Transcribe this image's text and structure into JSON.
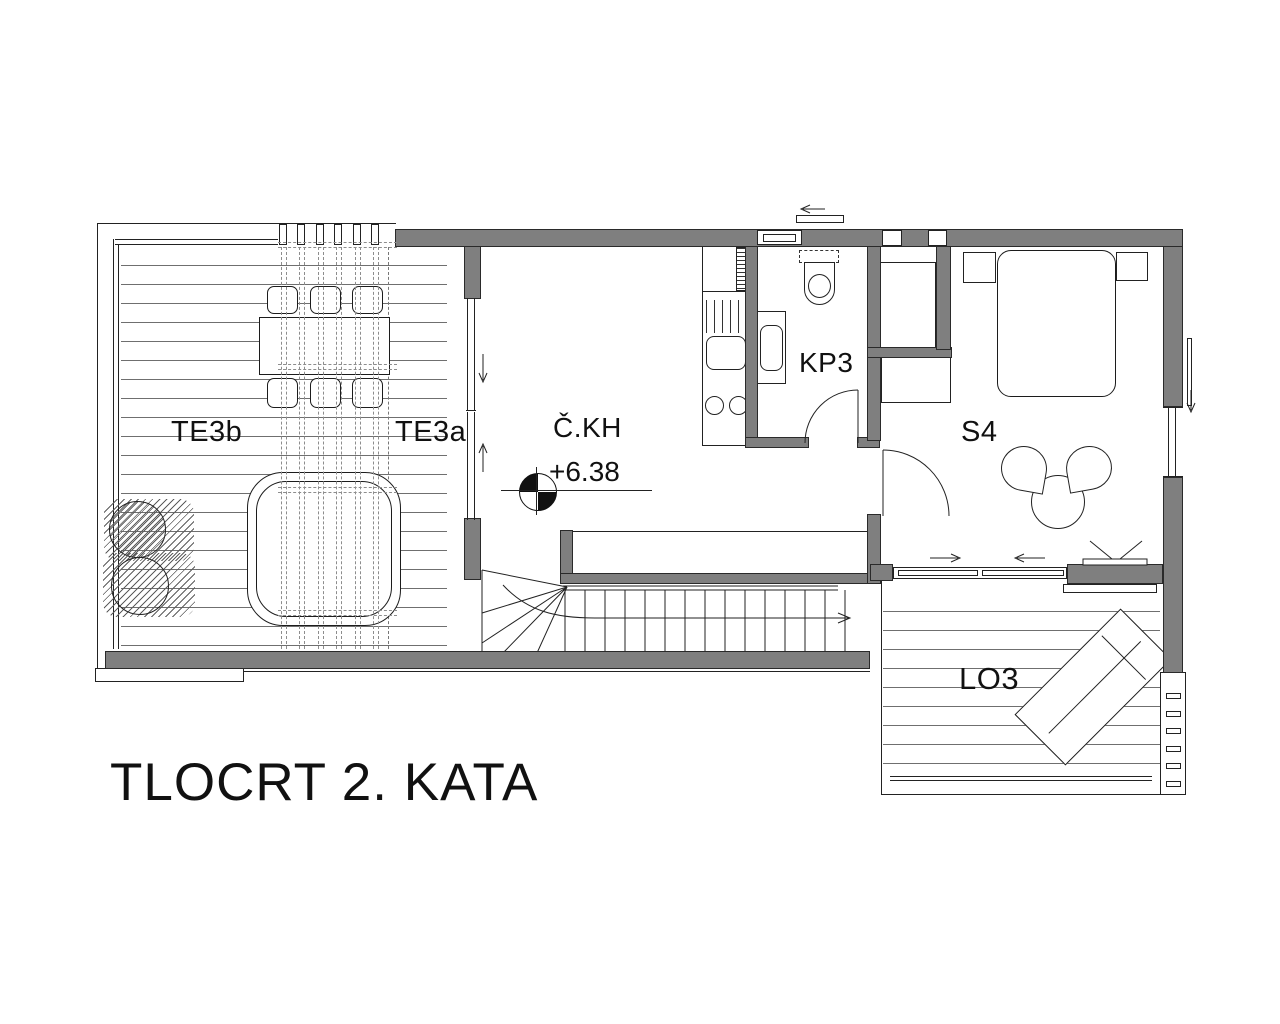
{
  "title": "TLOCRT 2. KATA",
  "rooms": {
    "te3b": "TE3b",
    "te3a": "TE3a",
    "ckh": "Č.KH",
    "kp3": "KP3",
    "s4": "S4",
    "lo3": "LO3"
  },
  "elevation_marker": {
    "value": "+6.38"
  },
  "colors": {
    "background": "#ffffff",
    "wall_fill": "#7f7f7f",
    "line": "#222222",
    "deck_line": "#6f6f6f",
    "pergola_dash": "#8d8d8d"
  }
}
